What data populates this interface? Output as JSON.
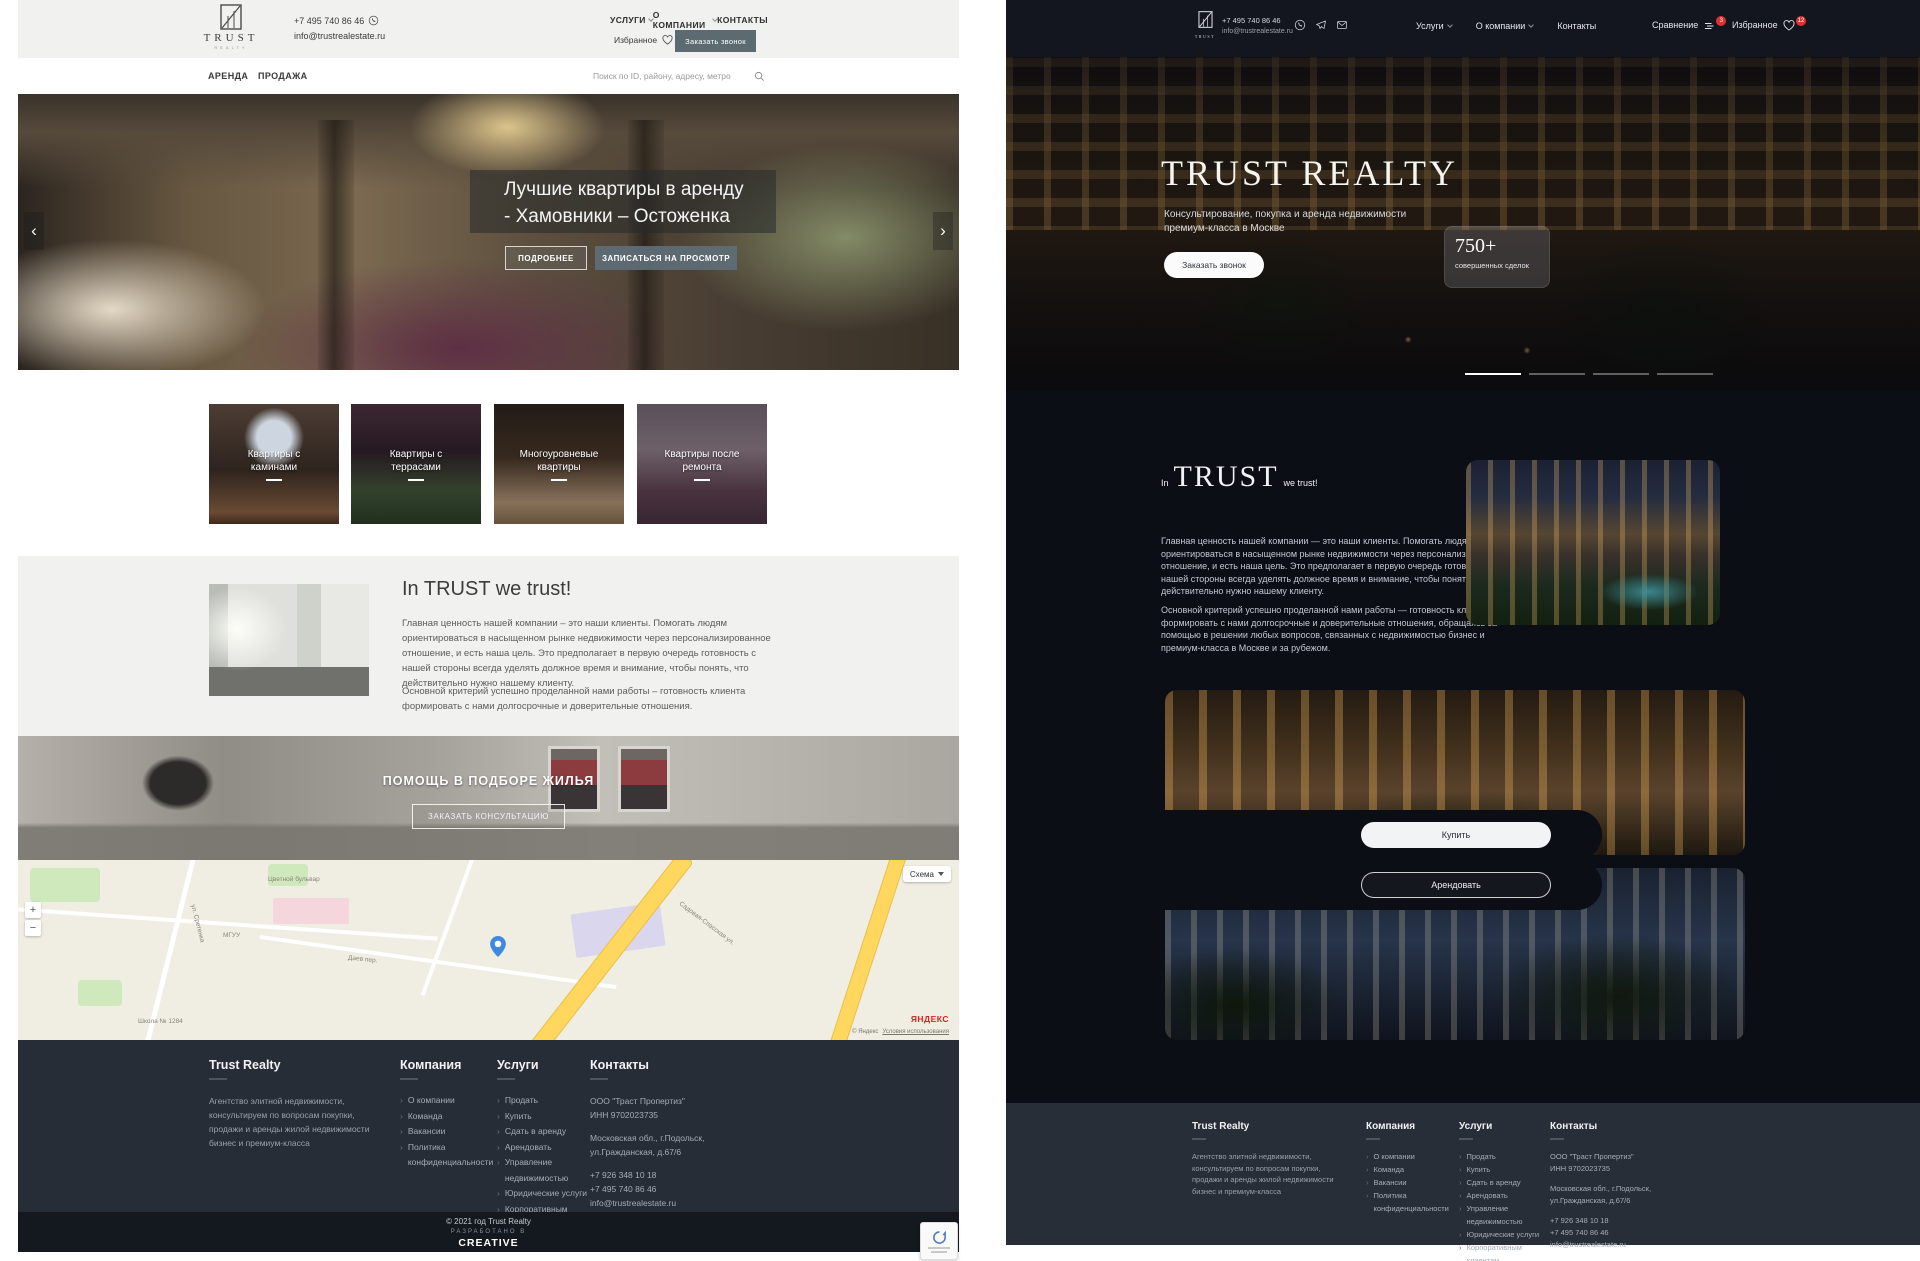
{
  "colors": {
    "accent_slate": "#5c6a71",
    "badge_red": "#e03131",
    "dark_bg": "#0c0e16",
    "footer_bg": "#272d36",
    "light_header_bg": "#f1f1ef",
    "yandex_red": "#e02020",
    "pin_blue": "#3f8ae0"
  },
  "light": {
    "header": {
      "logo_title": "TRUST",
      "logo_subtitle": "REALTY",
      "phone": "+7 495 740 86 46",
      "email": "info@trustrealestate.ru",
      "nav_services": "УСЛУГИ",
      "nav_company": "О КОМПАНИИ",
      "nav_contacts": "КОНТАКТЫ",
      "favorites": "Избранное",
      "call_button": "Заказать звонок"
    },
    "subnav": {
      "rent": "АРЕНДА",
      "sale": "ПРОДАЖА",
      "search_placeholder": "Поиск по ID, району, адресу, метро"
    },
    "hero": {
      "title": "Лучшие квартиры в аренду - Хамовники – Остоженка",
      "more_button": "ПОДРОБНЕЕ",
      "book_button": "ЗАПИСАТЬСЯ НА ПРОСМОТР",
      "prev_arrow": "‹",
      "next_arrow": "›"
    },
    "categories": [
      "Квартиры с каминами",
      "Квартиры с террасами",
      "Многоуровневые квартиры",
      "Квартиры после ремонта"
    ],
    "about": {
      "title": "In TRUST we trust!",
      "p1": "Главная ценность нашей компании – это наши клиенты. Помогать людям ориентироваться в насыщенном рынке недвижимости через персонализированное отношение, и есть наша цель. Это предполагает в первую очередь готовность с нашей стороны всегда уделять должное время и внимание, чтобы понять, что действительно нужно нашему клиенту.",
      "p2": "Основной критерий успешно проделанной нами работы – готовность клиента формировать с нами долгосрочные и доверительные отношения."
    },
    "help": {
      "title": "ПОМОЩЬ В ПОДБОРЕ ЖИЛЬЯ",
      "button": "ЗАКАЗАТЬ КОНСУЛЬТАЦИЮ"
    },
    "map": {
      "scheme": "Схема",
      "street_1": "Садовая-Спасская ул.",
      "street_2": "ул. Сретенка",
      "street_3": "Цветной бульвар",
      "street_4": "Даев пер.",
      "poi_1": "МГУУ",
      "poi_2": "Школа № 1284",
      "zoom_in": "+",
      "zoom_out": "−",
      "yandex": "ЯНДЕКС",
      "copyright": "© Яндекс",
      "terms": "Условия использования"
    }
  },
  "dark": {
    "header": {
      "logo_title": "TRUST",
      "phone": "+7 495 740 86 46",
      "email": "info@trustrealestate.ru",
      "nav_services": "Услуги",
      "nav_company": "О компании",
      "nav_contacts": "Контакты",
      "compare": "Сравнение",
      "compare_badge": "3",
      "favorites": "Избранное",
      "favorites_badge": "12"
    },
    "hero": {
      "title": "TRUST REALTY",
      "subtitle": "Консультирование, покупка и аренда недвижимости премиум-класса в Москве",
      "call_button": "Заказать звонок",
      "deals_value": "750+",
      "deals_label": "совершенных сделок"
    },
    "about": {
      "title_pre": "In",
      "title_word": "TRUST",
      "title_post": "we trust!",
      "p1": "Главная ценность нашей компании — это наши клиенты. Помогать людям ориентироваться в насыщенном рынке недвижимости через персонализированное отношение, и есть наша цель. Это предполагает в первую очередь готовность с нашей стороны всегда уделять должное время и внимание, чтобы понять, что действительно нужно нашему клиенту.",
      "p2": "Основной критерий успешно проделанной нами работы — готовность клиента формировать с нами долгосрочные и доверительные отношения, обращаясь за помощью в решении любых вопросов, связанных с недвижимостью бизнес и премиум-класса в Москве и за рубежом."
    },
    "buy_button": "Купить",
    "rent_button": "Арендовать"
  },
  "footer": {
    "brand": "Trust Realty",
    "description": "Агентство элитной недвижимости, консультируем по вопросам покупки, продажи и аренды жилой недвижимости бизнес и премиум-класса",
    "company_title": "Компания",
    "company_items": [
      "О компании",
      "Команда",
      "Вакансии",
      "Политика конфиденциальности"
    ],
    "services_title": "Услуги",
    "services_items": [
      "Продать",
      "Купить",
      "Сдать в аренду",
      "Арендовать",
      "Управление недвижимостью",
      "Юридические услуги",
      "Корпоративным клиентам"
    ],
    "contacts_title": "Контакты",
    "contacts_lines": [
      "ООО \"Траст Пропертиз\"",
      "ИНН 9702023735",
      "Московская обл., г.Подольск,",
      "ул.Гражданская, д.67/6",
      "+7 926 348 10 18",
      "+7 495 740 86 46",
      "info@trustrealestate.ru"
    ],
    "item_arrow": "›",
    "copyright": "© 2021 год Trust Realty",
    "developed": "РАЗРАБОТАНО В",
    "studio": "CREATIVE"
  }
}
